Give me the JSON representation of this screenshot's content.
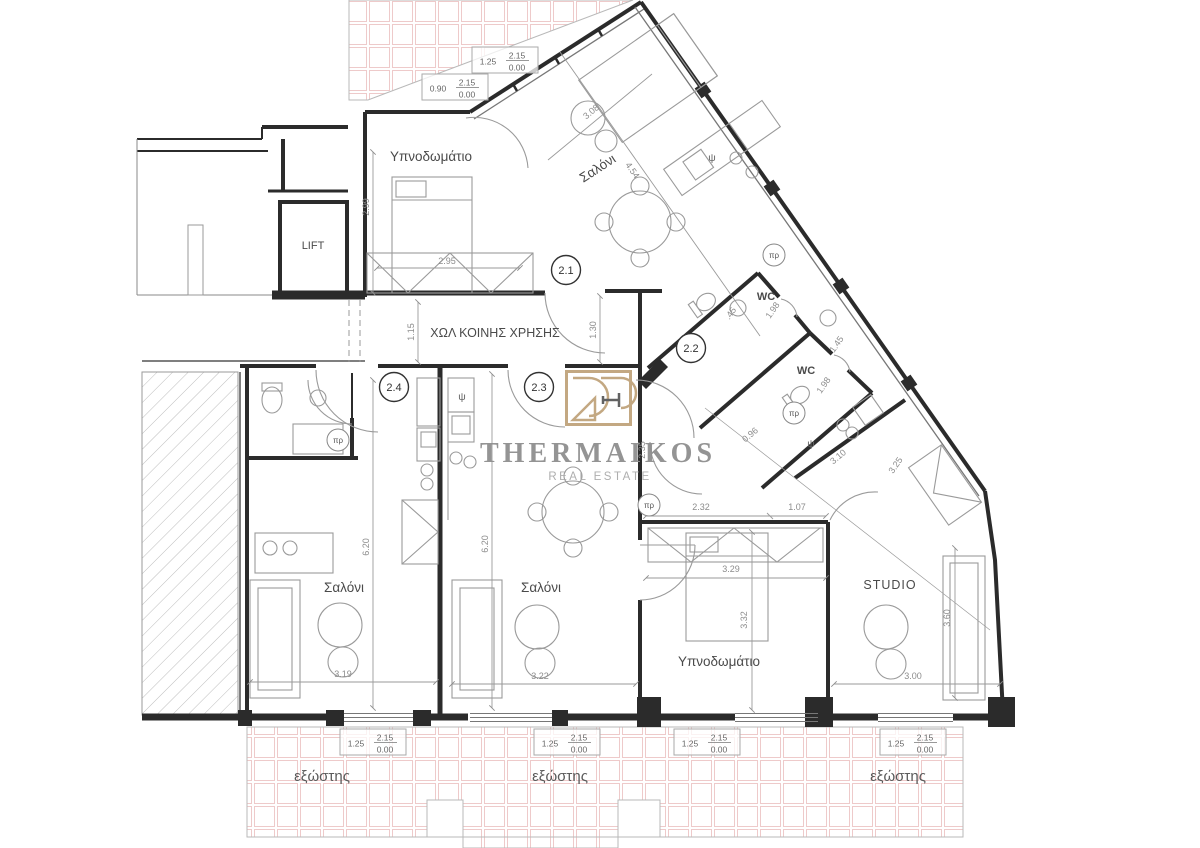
{
  "logo": {
    "name": "THERMAIKOS",
    "tagline": "REAL ESTATE"
  },
  "labels": {
    "hall": "ΧΩΛ ΚΟΙΝΗΣ ΧΡΗΣΗΣ",
    "bedroom": "Υπνοδωμάτιο",
    "salon": "Σαλόνι",
    "studio": "STUDIO",
    "lift": "LIFT",
    "wc": "WC",
    "balcony": "εξώστης"
  },
  "symbols": {
    "psi": "ψ",
    "pr": "πρ"
  },
  "units": {
    "u1": "2.1",
    "u2": "2.2",
    "u3": "2.3",
    "u4": "2.4"
  },
  "dims": {
    "d299": "2.99",
    "d295": "2.95",
    "d308": "3.08",
    "d454": "4.54",
    "d115": "1.15",
    "d130": "1.30",
    "d045": ".45",
    "d198": "1.98",
    "d145": "1.45",
    "d096": "0.96",
    "d310": "3.10",
    "d325": "3.25",
    "d235": "2.35",
    "d232": "2.32",
    "d107": "1.07",
    "d329": "3.29",
    "d332": "3.32",
    "d300": "3.00",
    "d360": "3.60",
    "d319": "3.19",
    "d322": "3.22",
    "d620": "6.20"
  },
  "dimbox": {
    "w090": "0.90",
    "w125": "1.25",
    "h": "2.15",
    "s": "0.00"
  },
  "colors": {
    "wall": "#2b2b2b",
    "tile_pink": "#eecaca",
    "logo_gold": "#c0a47c",
    "logo_text": "#8f8f8f",
    "furniture_gray": "#9a9a9a"
  }
}
